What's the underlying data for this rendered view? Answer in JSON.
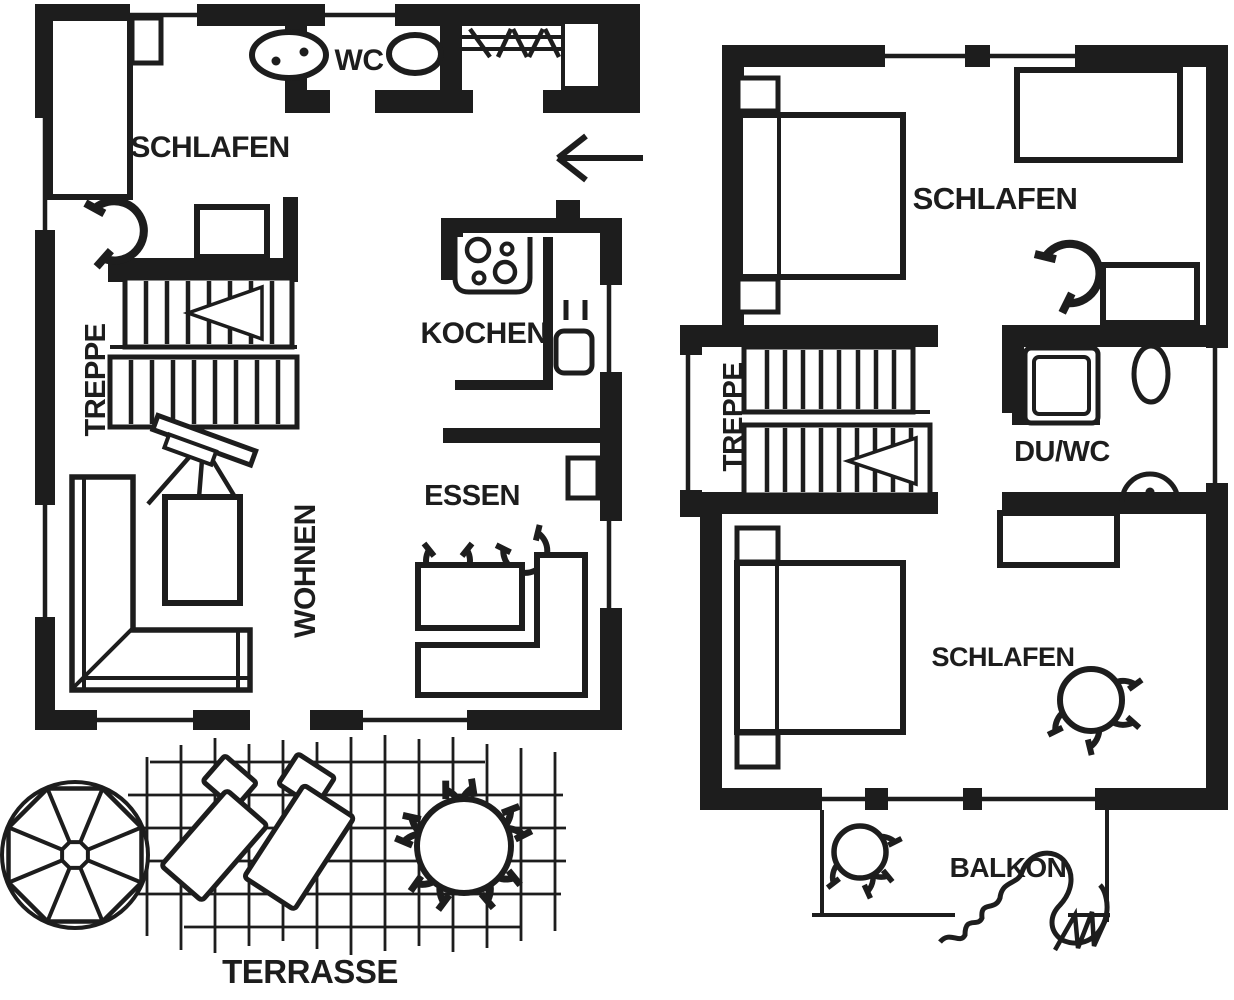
{
  "palette": {
    "ink": "#1d1d1d",
    "paper": "#ffffff"
  },
  "ground_floor": {
    "schlafen_label": "SCHLAFEN",
    "wc_label": "WC",
    "kochen_label": "KOCHEN",
    "treppe_label": "TREPPE",
    "wohnen_label": "WOHNEN",
    "essen_label": "ESSEN",
    "terrasse_label": "TERRASSE"
  },
  "upper_floor": {
    "schlafen_top_label": "SCHLAFEN",
    "treppe_label": "TREPPE",
    "du_wc_label": "DU/WC",
    "schlafen_bottom_label": "SCHLAFEN",
    "balkon_label": "BALKON"
  },
  "symbols": [
    "single-bed-icon",
    "double-bed-icon",
    "nightstand-icon",
    "washbasin-icon",
    "toilet-icon",
    "wardrobe-icon",
    "hob-icon",
    "kitchen-sink-icon",
    "stairs-icon",
    "stair-direction-arrow-icon",
    "corner-sofa-icon",
    "coffee-table-icon",
    "tv-on-stand-icon",
    "dining-table-icon",
    "corner-bench-icon",
    "chair-icon",
    "door-swing-icon",
    "shower-icon",
    "parasol-icon",
    "sun-lounger-icon",
    "round-table-icon",
    "plant-icon",
    "entrance-arrow-icon",
    "dimension-line"
  ]
}
